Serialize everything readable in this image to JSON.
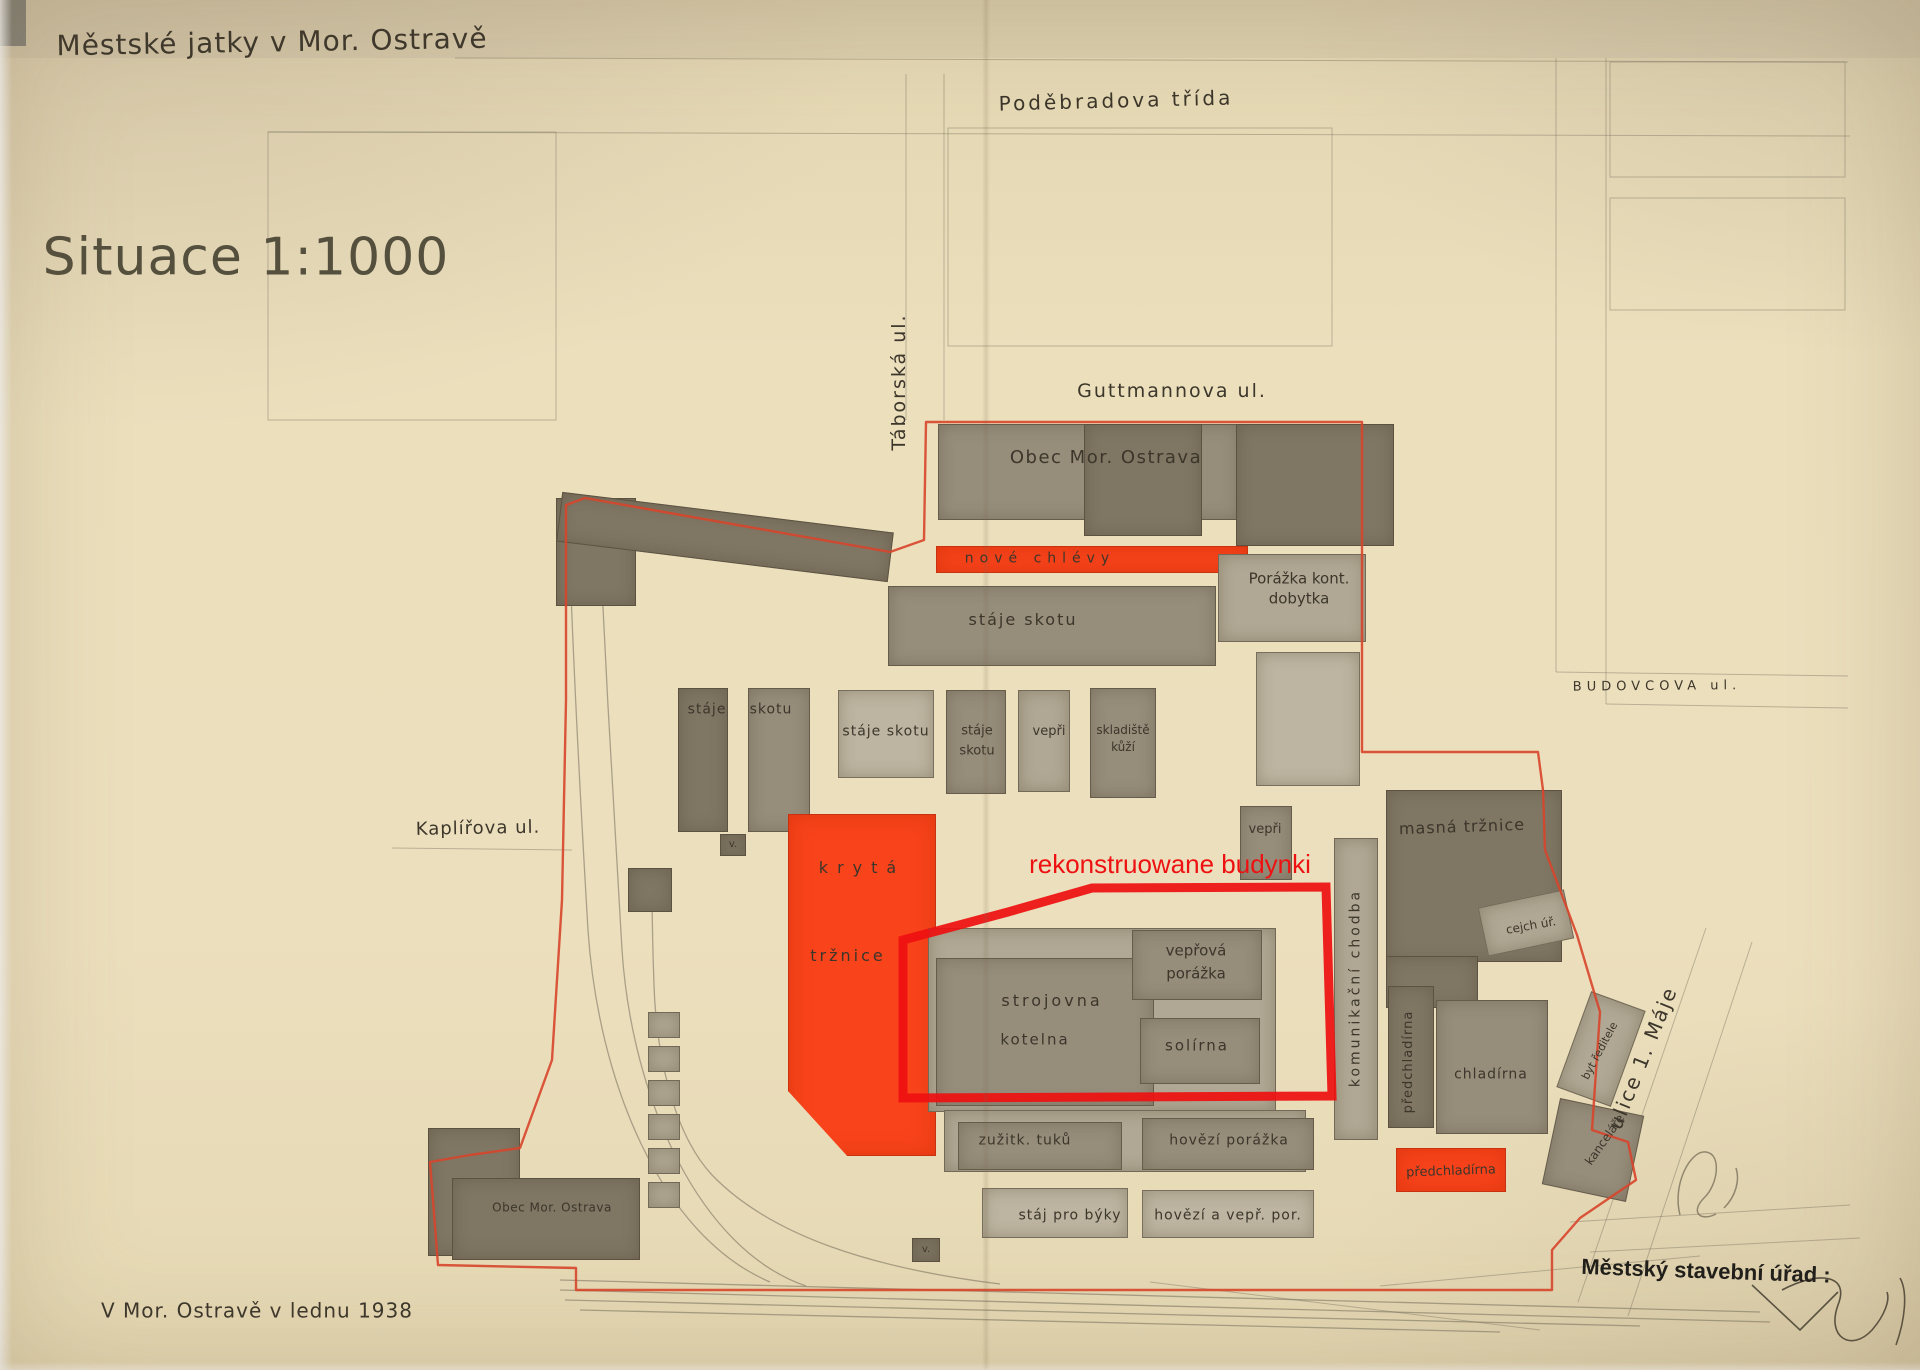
{
  "document": {
    "title": "Městské jatky v Mor. Ostravě",
    "scale": "Situace 1:1000",
    "date": "V Mor. Ostravě v lednu 1938",
    "authority_stamp": "Městský stavební úřad :",
    "overlay_annotation": "rekonstruowane budynki",
    "streets": [
      "Poděbradova třída",
      "Guttmannova ul.",
      "Táborská ul.",
      "BUDOVCOVA ul.",
      "Kaplířova ul.",
      "ulice 1. Máje"
    ]
  },
  "map": {
    "colors": {
      "paper": "#ebdfbc",
      "ink": "#3c362b",
      "inkSoft": "#55503e",
      "stamp": "#211f1b",
      "dark": "#7f7664",
      "mid": "#968d7b",
      "light": "#b0a894",
      "light2": "#bdb5a1",
      "red": "#f8431b",
      "redLine": "#d8452b",
      "overlayRed": "#ee1111",
      "pencil": "#7d7664"
    },
    "labels": [
      {
        "n": "plan-title",
        "t": "Městské jatky v Mor. Ostravě",
        "x": 272,
        "y": 42,
        "s": 28,
        "r": -1,
        "sp": 1,
        "w": 500
      },
      {
        "n": "scale-label",
        "t": "Situace 1:1000",
        "x": 246,
        "y": 258,
        "s": 52,
        "sp": 1,
        "c": "inkSoft"
      },
      {
        "n": "street-podebradova",
        "t": "Poděbradova třída",
        "x": 1116,
        "y": 101,
        "s": 20,
        "r": -1.5,
        "sp": 3
      },
      {
        "n": "street-guttmannova",
        "t": "Guttmannova ul.",
        "x": 1172,
        "y": 392,
        "s": 19,
        "sp": 2
      },
      {
        "n": "street-taborska",
        "t": "Táborská ul.",
        "x": 900,
        "y": 382,
        "s": 19,
        "r": -90,
        "sp": 2
      },
      {
        "n": "street-budovcova",
        "t": "BUDOVCOVA ul.",
        "x": 1657,
        "y": 687,
        "s": 13,
        "r": -0.5,
        "sp": 5
      },
      {
        "n": "street-kaplirova",
        "t": "Kaplířova ul.",
        "x": 478,
        "y": 829,
        "s": 18,
        "r": -1,
        "sp": 1
      },
      {
        "n": "street-ulice-1-maje",
        "t": "ulice 1. Máje",
        "x": 1643,
        "y": 1058,
        "s": 20,
        "r": -68,
        "sp": 2
      },
      {
        "n": "bld-label-obec-top",
        "t": "Obec Mor. Ostrava",
        "x": 1106,
        "y": 458,
        "s": 18,
        "sp": 1.5
      },
      {
        "n": "bld-label-nove-chlevy",
        "t": "nové chlévy",
        "x": 1040,
        "y": 559,
        "s": 14,
        "sp": 6
      },
      {
        "n": "bld-label-porazka-kont",
        "t": "Porážka kont.\ndobytka",
        "x": 1299,
        "y": 589,
        "s": 15,
        "lh": 1.3
      },
      {
        "n": "bld-label-staje-skotu-1",
        "t": "stáje skotu",
        "x": 1023,
        "y": 620,
        "s": 16,
        "sp": 2
      },
      {
        "n": "bld-label-staje-2",
        "t": "stáje",
        "x": 707,
        "y": 710,
        "s": 14,
        "sp": 1
      },
      {
        "n": "bld-label-skotu-2",
        "t": "skotu",
        "x": 771,
        "y": 710,
        "s": 14,
        "sp": 1
      },
      {
        "n": "bld-label-staje-skotu-3",
        "t": "stáje skotu",
        "x": 886,
        "y": 732,
        "s": 14,
        "sp": 1
      },
      {
        "n": "bld-label-staje-skotu-4",
        "t": "stáje\nskotu",
        "x": 977,
        "y": 741,
        "s": 13,
        "lh": 1.5
      },
      {
        "n": "bld-label-vepri-1",
        "t": "vepři",
        "x": 1049,
        "y": 732,
        "s": 13
      },
      {
        "n": "bld-label-skladiste-kuzi",
        "t": "skladiště\nkůží",
        "x": 1123,
        "y": 739,
        "s": 12,
        "lh": 1.4
      },
      {
        "n": "bld-label-vepri-2",
        "t": "vepři",
        "x": 1265,
        "y": 830,
        "s": 13
      },
      {
        "n": "bld-label-masna-trznice",
        "t": "masná tržnice",
        "x": 1462,
        "y": 827,
        "s": 16,
        "r": -2,
        "sp": 1
      },
      {
        "n": "bld-label-kryta",
        "t": "krytá",
        "x": 862,
        "y": 868,
        "s": 16,
        "sp": 9
      },
      {
        "n": "bld-label-trznice",
        "t": "tržnice",
        "x": 848,
        "y": 956,
        "s": 16,
        "sp": 3
      },
      {
        "n": "overlay-annotation",
        "t": "rekonstruowane budynki",
        "x": 1170,
        "y": 864,
        "s": 26,
        "c": "overlayRed",
        "f": "sans"
      },
      {
        "n": "bld-label-veprova-porazka",
        "t": "vepřová\nporážka",
        "x": 1196,
        "y": 962,
        "s": 15,
        "lh": 1.5
      },
      {
        "n": "bld-label-strojovna",
        "t": "strojovna",
        "x": 1052,
        "y": 1001,
        "s": 16,
        "sp": 3
      },
      {
        "n": "bld-label-kotelna",
        "t": "kotelna",
        "x": 1035,
        "y": 1040,
        "s": 15,
        "sp": 2
      },
      {
        "n": "bld-label-solirna",
        "t": "solírna",
        "x": 1197,
        "y": 1046,
        "s": 15,
        "sp": 2
      },
      {
        "n": "bld-label-komunikacni-chodba",
        "t": "komunikační chodba",
        "x": 1356,
        "y": 988,
        "s": 14,
        "r": -90,
        "sp": 3
      },
      {
        "n": "bld-label-cejch-ur",
        "t": "cejch úř.",
        "x": 1531,
        "y": 926,
        "s": 12,
        "r": -10
      },
      {
        "n": "bld-label-predchladirna-1",
        "t": "předchladírna",
        "x": 1409,
        "y": 1062,
        "s": 13,
        "r": -90,
        "sp": 1
      },
      {
        "n": "bld-label-chladirna",
        "t": "chladírna",
        "x": 1491,
        "y": 1075,
        "s": 14,
        "sp": 1
      },
      {
        "n": "bld-label-byt-reditele",
        "t": "byt ředitele",
        "x": 1600,
        "y": 1051,
        "s": 11,
        "r": -62
      },
      {
        "n": "bld-label-kancelare",
        "t": "kanceláře",
        "x": 1605,
        "y": 1140,
        "s": 12,
        "r": -55
      },
      {
        "n": "bld-label-zuzitk-tuku",
        "t": "zužitk. tuků",
        "x": 1025,
        "y": 1141,
        "s": 14,
        "sp": 1
      },
      {
        "n": "bld-label-hovezi-porazka",
        "t": "hovězí porážka",
        "x": 1229,
        "y": 1141,
        "s": 14,
        "sp": 1
      },
      {
        "n": "bld-label-staj-pro-byky",
        "t": "stáj pro býky",
        "x": 1070,
        "y": 1216,
        "s": 14,
        "sp": 1
      },
      {
        "n": "bld-label-hovezi-vepr-por",
        "t": "hovězí a vepř. por.",
        "x": 1228,
        "y": 1216,
        "s": 14,
        "sp": 1
      },
      {
        "n": "bld-label-predchladirna-2",
        "t": "předchladírna",
        "x": 1451,
        "y": 1172,
        "s": 13,
        "r": -2
      },
      {
        "n": "bld-label-obec-bottom",
        "t": "Obec Mor. Ostrava",
        "x": 552,
        "y": 1208,
        "s": 12,
        "sp": 0.5
      },
      {
        "n": "bld-label-v-1",
        "t": "v.",
        "x": 733,
        "y": 845,
        "s": 10
      },
      {
        "n": "bld-label-v-2",
        "t": "v.",
        "x": 926,
        "y": 1250,
        "s": 10
      },
      {
        "n": "date-label",
        "t": "V Mor. Ostravě v lednu 1938",
        "x": 257,
        "y": 1311,
        "s": 20,
        "sp": 1
      },
      {
        "n": "stamp-label",
        "t": "Městský stavební úřad :",
        "x": 1706,
        "y": 1271,
        "s": 22,
        "r": 2,
        "w": 700,
        "c": "stamp",
        "f": "sans"
      }
    ],
    "buildings": [
      {
        "n": "nw-wing-block",
        "x": 556,
        "y": 498,
        "w": 80,
        "h": 108,
        "sh": "dark"
      },
      {
        "n": "nw-long-building",
        "x": 558,
        "y": 512,
        "w": 334,
        "h": 50,
        "sh": "dark",
        "r": 7
      },
      {
        "n": "obec-north-a",
        "x": 938,
        "y": 424,
        "w": 302,
        "h": 96,
        "sh": "mid"
      },
      {
        "n": "obec-north-b",
        "x": 1236,
        "y": 424,
        "w": 158,
        "h": 122,
        "sh": "dark"
      },
      {
        "n": "obec-north-c",
        "x": 1084,
        "y": 424,
        "w": 118,
        "h": 112,
        "sh": "dark"
      },
      {
        "n": "nove-chlevy-building",
        "x": 936,
        "y": 546,
        "w": 312,
        "h": 27,
        "sh": "red"
      },
      {
        "n": "porazka-kont-building",
        "x": 1218,
        "y": 554,
        "w": 148,
        "h": 88,
        "sh": "light"
      },
      {
        "n": "staje-skotu-1-building",
        "x": 888,
        "y": 586,
        "w": 328,
        "h": 80,
        "sh": "mid"
      },
      {
        "n": "staje-2-building",
        "x": 678,
        "y": 688,
        "w": 50,
        "h": 144,
        "sh": "dark"
      },
      {
        "n": "skotu-2-building",
        "x": 748,
        "y": 688,
        "w": 62,
        "h": 144,
        "sh": "mid"
      },
      {
        "n": "v-1-building",
        "x": 720,
        "y": 834,
        "w": 26,
        "h": 22,
        "sh": "dark"
      },
      {
        "n": "staje-skotu-3-building",
        "x": 838,
        "y": 690,
        "w": 96,
        "h": 88,
        "sh": "light2"
      },
      {
        "n": "staje-skotu-4-building",
        "x": 946,
        "y": 690,
        "w": 60,
        "h": 104,
        "sh": "mid"
      },
      {
        "n": "vepri-1-building",
        "x": 1018,
        "y": 690,
        "w": 52,
        "h": 102,
        "sh": "light"
      },
      {
        "n": "skladiste-building",
        "x": 1090,
        "y": 688,
        "w": 66,
        "h": 110,
        "sh": "mid"
      },
      {
        "n": "north-light-building",
        "x": 1256,
        "y": 652,
        "w": 104,
        "h": 134,
        "sh": "light2"
      },
      {
        "n": "vepri-2-building",
        "x": 1240,
        "y": 806,
        "w": 52,
        "h": 74,
        "sh": "mid"
      },
      {
        "n": "masna-building",
        "x": 1386,
        "y": 790,
        "w": 176,
        "h": 172,
        "sh": "dark"
      },
      {
        "n": "masna-ext-building",
        "x": 1386,
        "y": 956,
        "w": 92,
        "h": 52,
        "sh": "dark"
      },
      {
        "n": "cejch-building",
        "x": 1482,
        "y": 898,
        "w": 88,
        "h": 50,
        "sh": "light",
        "r": -12
      },
      {
        "n": "kryta-trznice-building",
        "x": 788,
        "y": 814,
        "w": 148,
        "h": 342,
        "sh": "red",
        "cp": "polygon(0% 0%, 100% 0%, 100% 100%, 40% 100%, 0% 81%)"
      },
      {
        "n": "central-light-block",
        "x": 928,
        "y": 928,
        "w": 348,
        "h": 184,
        "sh": "light"
      },
      {
        "n": "strojovna-kotelna-building",
        "x": 936,
        "y": 958,
        "w": 218,
        "h": 148,
        "sh": "mid"
      },
      {
        "n": "veprova-building",
        "x": 1132,
        "y": 930,
        "w": 130,
        "h": 70,
        "sh": "mid"
      },
      {
        "n": "solirna-building",
        "x": 1140,
        "y": 1018,
        "w": 120,
        "h": 66,
        "sh": "mid"
      },
      {
        "n": "chodba-building",
        "x": 1334,
        "y": 838,
        "w": 44,
        "h": 302,
        "sh": "light"
      },
      {
        "n": "predchladirna-1-building",
        "x": 1388,
        "y": 986,
        "w": 46,
        "h": 142,
        "sh": "dark"
      },
      {
        "n": "chladirna-building",
        "x": 1436,
        "y": 1000,
        "w": 112,
        "h": 134,
        "sh": "mid"
      },
      {
        "n": "predchladirna-2-building",
        "x": 1396,
        "y": 1148,
        "w": 110,
        "h": 44,
        "sh": "red"
      },
      {
        "n": "byt-reditele-building",
        "x": 1572,
        "y": 998,
        "w": 58,
        "h": 102,
        "sh": "light",
        "r": 20
      },
      {
        "n": "kancelare-building",
        "x": 1550,
        "y": 1106,
        "w": 86,
        "h": 88,
        "sh": "mid",
        "r": 12
      },
      {
        "n": "zuzitk-bg-block",
        "x": 944,
        "y": 1110,
        "w": 362,
        "h": 62,
        "sh": "light"
      },
      {
        "n": "zuzitk-building",
        "x": 958,
        "y": 1122,
        "w": 164,
        "h": 48,
        "sh": "mid"
      },
      {
        "n": "hovezi-porazka-building",
        "x": 1142,
        "y": 1118,
        "w": 172,
        "h": 52,
        "sh": "mid"
      },
      {
        "n": "staj-byky-building",
        "x": 982,
        "y": 1188,
        "w": 146,
        "h": 50,
        "sh": "light2"
      },
      {
        "n": "hovezi-vepr-building",
        "x": 1142,
        "y": 1190,
        "w": 172,
        "h": 48,
        "sh": "light2"
      },
      {
        "n": "v-2-building",
        "x": 912,
        "y": 1238,
        "w": 28,
        "h": 24,
        "sh": "dark"
      },
      {
        "n": "obec-bottom-a",
        "x": 428,
        "y": 1128,
        "w": 92,
        "h": 128,
        "sh": "dark"
      },
      {
        "n": "obec-bottom-b",
        "x": 452,
        "y": 1178,
        "w": 188,
        "h": 82,
        "sh": "dark"
      },
      {
        "n": "rail-square-building",
        "x": 628,
        "y": 868,
        "w": 44,
        "h": 44,
        "sh": "dark"
      },
      {
        "n": "siding-box-1",
        "x": 648,
        "y": 1012,
        "w": 32,
        "h": 26,
        "sh": "light"
      },
      {
        "n": "siding-box-2",
        "x": 648,
        "y": 1046,
        "w": 32,
        "h": 26,
        "sh": "light"
      },
      {
        "n": "siding-box-3",
        "x": 648,
        "y": 1080,
        "w": 32,
        "h": 26,
        "sh": "light"
      },
      {
        "n": "siding-box-4",
        "x": 648,
        "y": 1114,
        "w": 32,
        "h": 26,
        "sh": "light"
      },
      {
        "n": "siding-box-5",
        "x": 648,
        "y": 1148,
        "w": 32,
        "h": 26,
        "sh": "light"
      },
      {
        "n": "siding-box-6",
        "x": 648,
        "y": 1182,
        "w": 32,
        "h": 26,
        "sh": "light"
      }
    ]
  }
}
